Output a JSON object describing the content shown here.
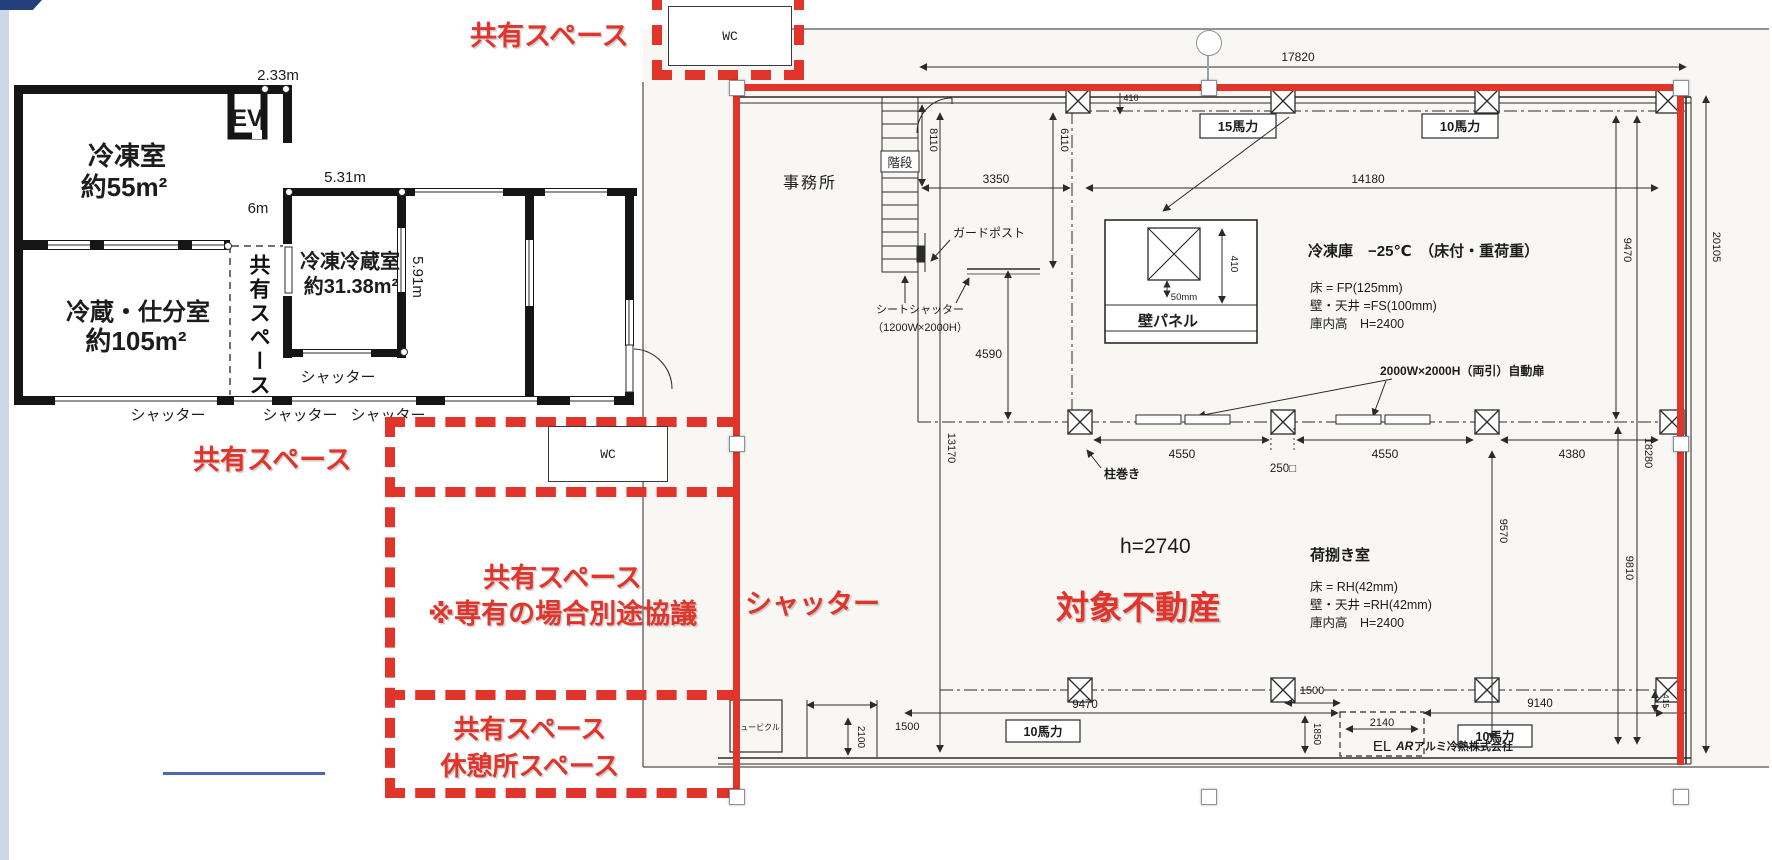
{
  "editor": {
    "rotate_icon": "↻"
  },
  "annotations": {
    "shared_top": "共有スペース",
    "wc_top": "WC",
    "shared_left": "共有スペース",
    "wc_lower": "WC",
    "shared_main_line1": "共有スペース",
    "shared_main_line2": "※専有の場合別途協議",
    "shared_bottom_line1": "共有スペース",
    "shared_bottom_line2": "休憩所スペース",
    "shutter_red": "シャッター",
    "target_property": "対象不動産"
  },
  "left_plan": {
    "rooms": {
      "freezer": {
        "name": "冷凍室",
        "area": "約55m²"
      },
      "chilled": {
        "name": "冷蔵・仕分室",
        "area": "約105m²"
      },
      "fc": {
        "name": "冷凍冷蔵室",
        "area": "約31.38m²"
      },
      "ev": "EV",
      "corridor": "共有スペース"
    },
    "dims": {
      "d233": "2.33m",
      "d531": "5.31m",
      "d6": "6m",
      "d591": "5.91m"
    },
    "shutters": {
      "inner": "シャッター",
      "s1": "シャッター",
      "s2": "シャッター",
      "s3": "シャッター"
    }
  },
  "right_plan": {
    "rooms": {
      "office": "事務所",
      "stairs": "階段",
      "loading": "荷捌き室"
    },
    "freezer_spec": {
      "title": "冷凍庫　−25℃　（床付・重荷重）",
      "floor": "床 = FP(125mm)",
      "wall": "壁・天井 =FS(100mm)",
      "height": "庫内高　H=2400"
    },
    "loading_spec": {
      "floor": "床 = RH(42mm)",
      "wall": "壁・天井 =RH(42mm)",
      "height": "庫内高　H=2400"
    },
    "labels": {
      "guard_post": "ガードポスト",
      "sheet_shutter1": "シートシャッター",
      "sheet_shutter2": "（1200W×2000H）",
      "wall_panel": "壁パネル",
      "panel_50": "50mm",
      "auto_door": "2000W×2000H（両引）自動扉",
      "column_wrap": "柱巻き",
      "ceiling_height": "h=2740",
      "cubicle": "キュービクル",
      "el": "EL"
    },
    "hp": {
      "hp15": "15馬力",
      "hp10_top": "10馬力",
      "hp10_bl": "10馬力",
      "hp10_br": "10馬力"
    },
    "dims": {
      "d17820": "17820",
      "d20105": "20105",
      "d8110": "8110",
      "d6110": "6110",
      "d3350": "3350",
      "d14180": "14180",
      "d410_top": "410",
      "d410_panel": "410",
      "d4590": "4590",
      "d13170": "13170",
      "d4550a": "4550",
      "d250": "250□",
      "d4550b": "4550",
      "d4380": "4380",
      "d9470r": "9470",
      "d18280": "18280",
      "d9570": "9570",
      "d9810": "9810",
      "d9470b": "9470",
      "d9140": "9140",
      "d1500a": "1500",
      "d2100": "2100",
      "d1500b": "1500",
      "d2140": "2140",
      "d1850": "1850",
      "d415": "415"
    },
    "company_mark": "AR",
    "company": "アルミ冷熱株式会社"
  }
}
